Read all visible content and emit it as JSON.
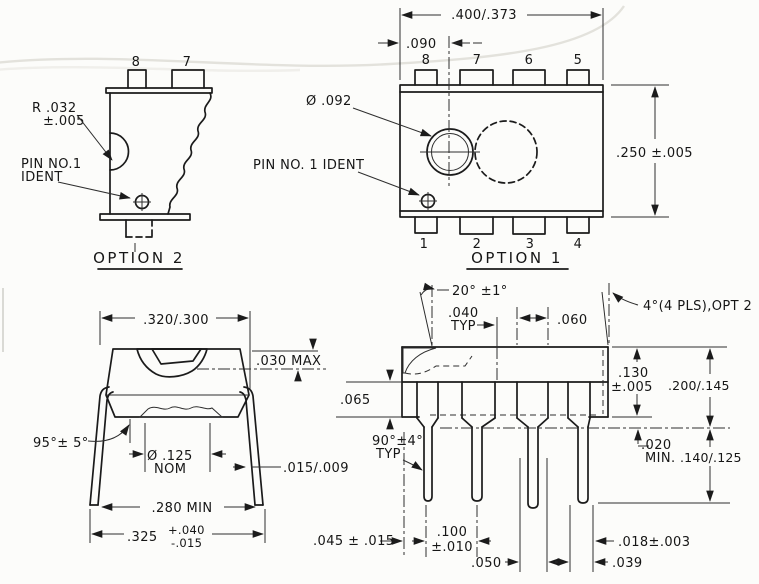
{
  "drawing": {
    "option2": {
      "title": "OPTION 2",
      "radius_note_line1": "R .032",
      "radius_note_line2": "±.005",
      "pin1_note_line1": "PIN NO.1",
      "pin1_note_line2": "IDENT",
      "pin_top_left": "8",
      "pin_top_right": "7"
    },
    "option1": {
      "title": "OPTION 1",
      "overall_width": ".400/.373",
      "lens_offset": ".090",
      "body_height": ".250 ±.005",
      "lens_diameter": "Ø .092",
      "pin1_note": "PIN NO. 1 IDENT",
      "pins_top": [
        "8",
        "7",
        "6",
        "5"
      ],
      "pins_bottom": [
        "1",
        "2",
        "3",
        "4"
      ]
    },
    "end_view": {
      "body_width": ".320/.300",
      "dome_height": ".030 MAX",
      "lead_splay_angle": "95°± 5°",
      "lens_dia_line1": "Ø .125",
      "lens_dia_line2": "NOM",
      "lead_thickness": ".015/.009",
      "span_min": ".280 MIN",
      "span_value": ".325",
      "span_tol_plus": "+.040",
      "span_tol_minus": "-.015"
    },
    "side_view": {
      "bevel_angle": "20° ±1°",
      "bevel_width_line1": ".040",
      "bevel_width_line2": "TYP",
      "shoulder_width": ".060",
      "draft_angle": "4°(4 PLS),OPT 2",
      "body_thickness_line1": ".130",
      "body_thickness_line2": "±.005",
      "overall_height": ".200/.145",
      "standoff_line1": ".020",
      "standoff_line2": "MIN.",
      "lead_length": ".140/.125",
      "shoulder_height": ".065",
      "lead_bend_line1": "90°±4°",
      "lead_bend_line2": "TYP",
      "end_clearance": ".045 ± .015",
      "pitch_line1": ".100",
      "pitch_line2": "±.010",
      "tip_offset": ".050",
      "lead_width": ".018±.003",
      "tip_width": ".039"
    }
  }
}
